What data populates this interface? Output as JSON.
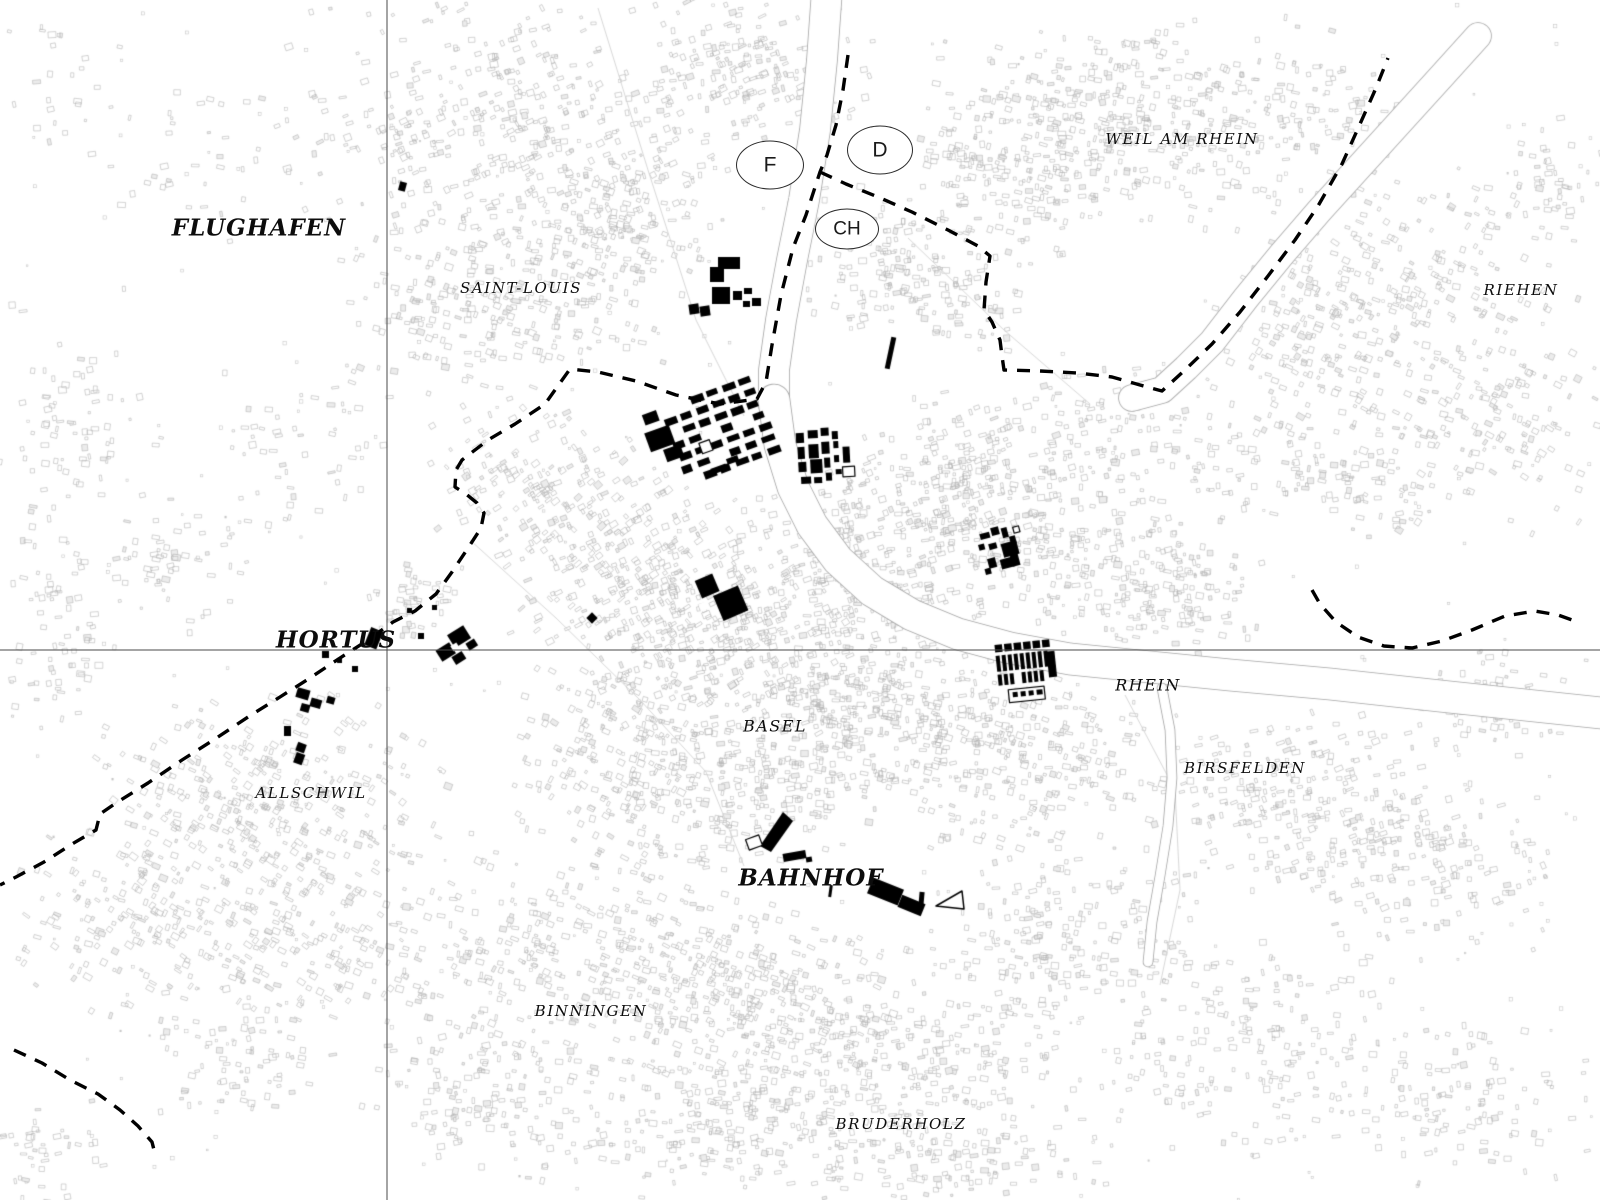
{
  "map": {
    "region_labels": [
      {
        "id": "flughafen",
        "text": "FLUGHAFEN",
        "x": 259,
        "y": 228,
        "style": "major"
      },
      {
        "id": "saint-louis",
        "text": "SAINT-LOUIS",
        "x": 521,
        "y": 288,
        "style": "town"
      },
      {
        "id": "weil-am-rhein",
        "text": "WEIL AM RHEIN",
        "x": 1182,
        "y": 139,
        "style": "town"
      },
      {
        "id": "riehen",
        "text": "RIEHEN",
        "x": 1521,
        "y": 290,
        "style": "town"
      },
      {
        "id": "hortus",
        "text": "HORTUS",
        "x": 336,
        "y": 640,
        "style": "major"
      },
      {
        "id": "allschwil",
        "text": "ALLSCHWIL",
        "x": 311,
        "y": 793,
        "style": "town"
      },
      {
        "id": "basel",
        "text": "BASEL",
        "x": 775,
        "y": 726,
        "style": "town-md"
      },
      {
        "id": "rhein",
        "text": "RHEIN",
        "x": 1148,
        "y": 685,
        "style": "town-md"
      },
      {
        "id": "birsfelden",
        "text": "BIRSFELDEN",
        "x": 1245,
        "y": 768,
        "style": "town"
      },
      {
        "id": "bahnhof",
        "text": "BAHNHOF",
        "x": 811,
        "y": 878,
        "style": "major"
      },
      {
        "id": "binningen",
        "text": "BINNINGEN",
        "x": 591,
        "y": 1011,
        "style": "town"
      },
      {
        "id": "bruderholz",
        "text": "BRUDERHOLZ",
        "x": 901,
        "y": 1124,
        "style": "town"
      }
    ],
    "country_markers": [
      {
        "id": "france",
        "text": "F",
        "x": 770,
        "y": 165,
        "w": 66,
        "h": 47,
        "font": 21
      },
      {
        "id": "germany",
        "text": "D",
        "x": 880,
        "y": 150,
        "w": 64,
        "h": 47,
        "font": 21
      },
      {
        "id": "switzerland",
        "text": "CH",
        "x": 847,
        "y": 229,
        "w": 62,
        "h": 39,
        "font": 19
      }
    ],
    "colors": {
      "background": "#ffffff",
      "building_outline": "#b3b3b3",
      "black_building": "#000000",
      "border_dash": "#000000",
      "river_edge": "#a6a6a6",
      "crosshair": "#4a4a4a"
    }
  }
}
